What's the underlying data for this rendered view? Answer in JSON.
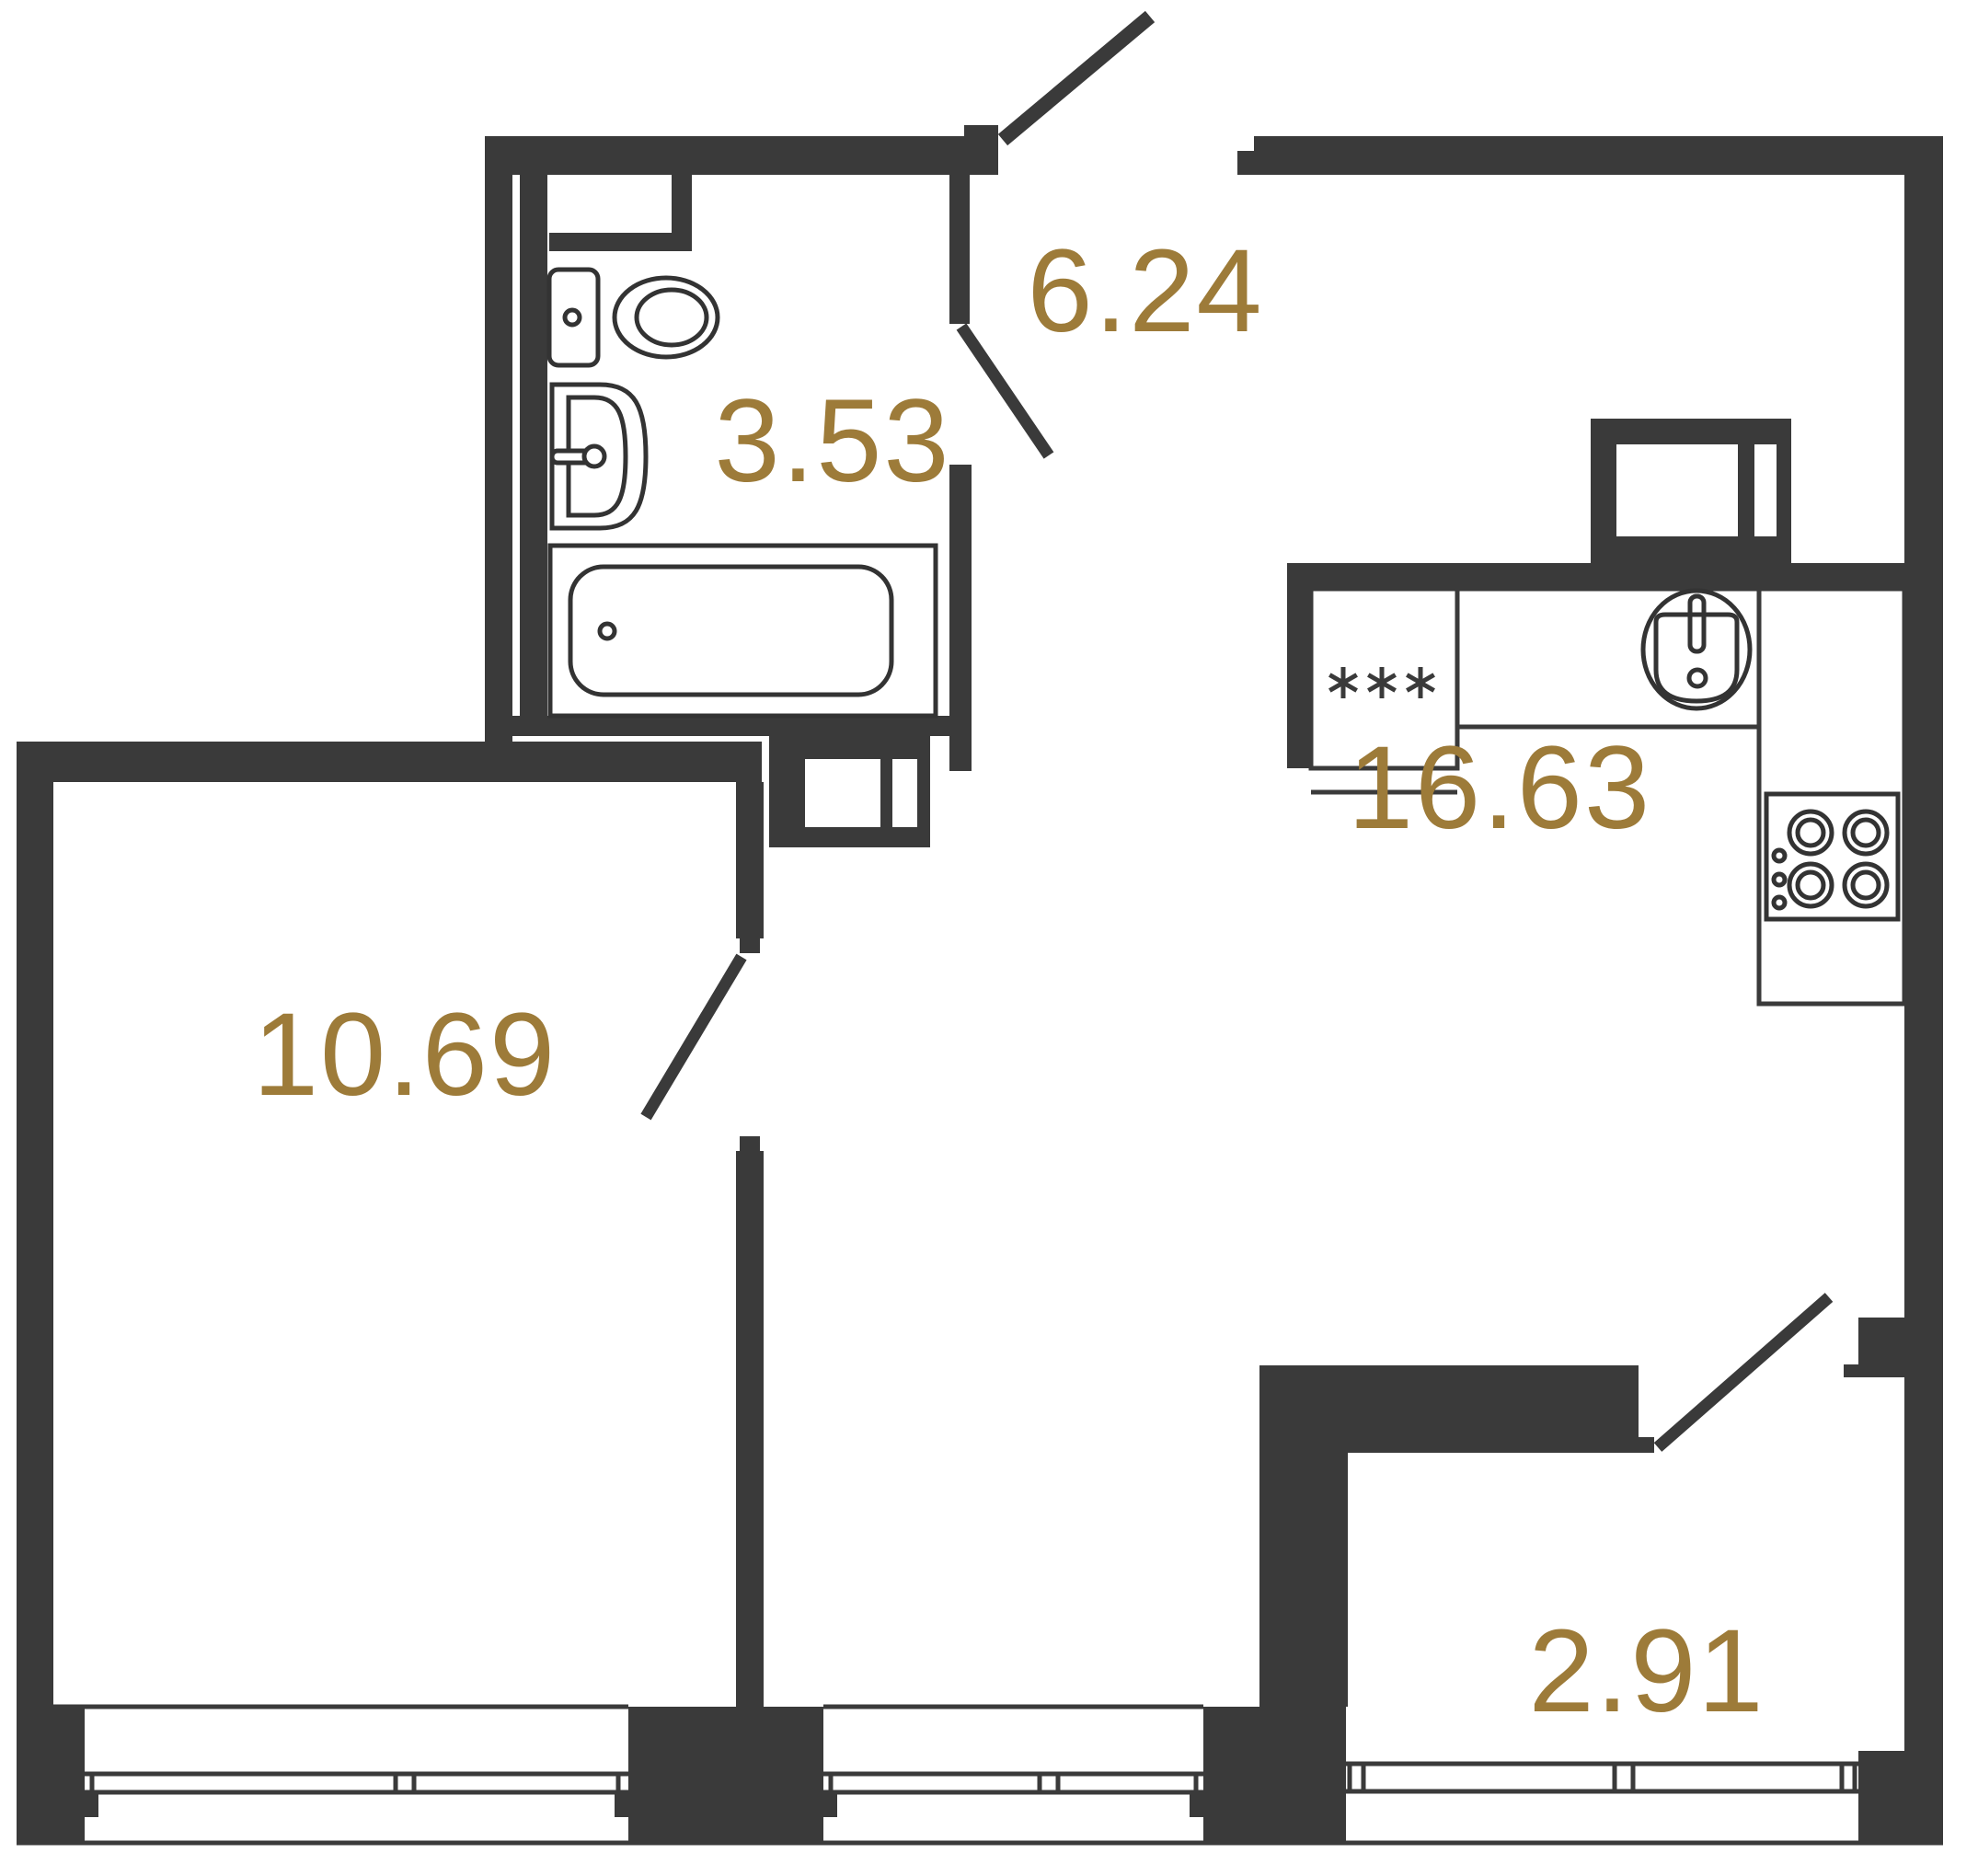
{
  "plan": {
    "type": "apartment-floor-plan",
    "wall_color": "#3a3a3a",
    "fixture_line_color": "#333333",
    "label_color": "#9d7b39",
    "rooms": [
      {
        "name": "hallway",
        "area": "6.24"
      },
      {
        "name": "bathroom",
        "area": "3.53"
      },
      {
        "name": "kitchen-living-room",
        "area": "16.63"
      },
      {
        "name": "room",
        "area": "10.69"
      },
      {
        "name": "balcony",
        "area": "2.91"
      }
    ],
    "fixtures": [
      "toilet",
      "wash-basin",
      "bathtub",
      "washing-machine",
      "fridge",
      "kitchen-sink",
      "cooktop"
    ]
  }
}
